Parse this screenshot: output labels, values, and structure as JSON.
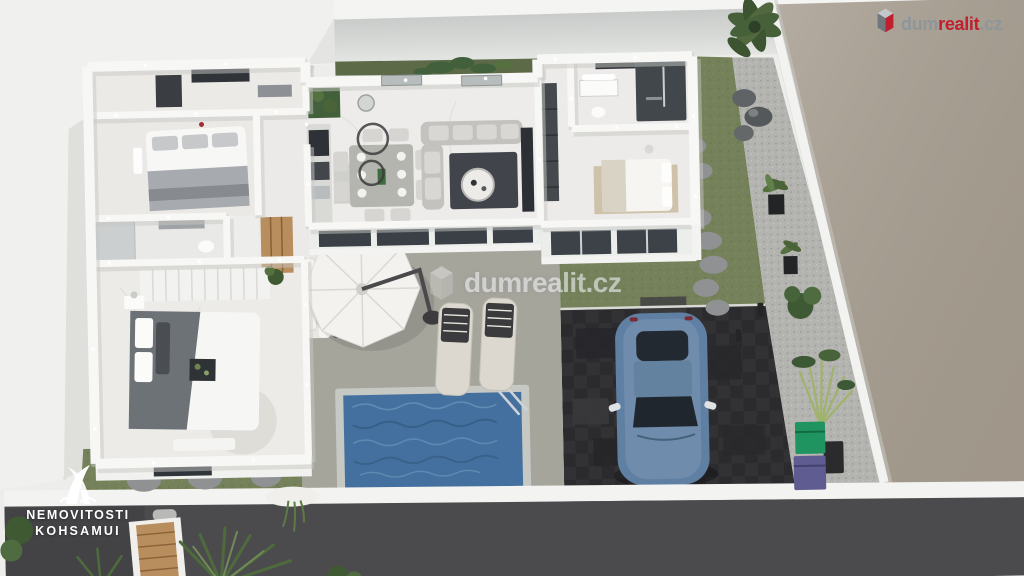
{
  "watermark": {
    "text": "dumrealit.cz"
  },
  "brand": {
    "prefix": "dum",
    "accent": "realit",
    "suffix": ".cz"
  },
  "agency": {
    "line1": "NEMOVITOSTI",
    "line2": "KOHSAMUI"
  },
  "icons": {
    "brand_icon": "dumrealit-cube-icon",
    "watermark_icon": "dumrealit-cube-icon",
    "agency_icon": "kohsamui-peaks-icon"
  },
  "colors": {
    "pool_water": "#44709f",
    "pool_coping": "#c6c8c3",
    "grass": "#75815a",
    "hedge": "#5c6a48",
    "gravel": "#b3b3af",
    "driveway": "#323235",
    "street": "#4b4b4d",
    "pavement": "#a89f91",
    "patio": "#a6a59c",
    "house_wall": "#f7f7f5",
    "car_body": "#5f7fa3",
    "wood": "#b98e5e",
    "bin_green": "#1f9460",
    "bin_purple": "#5e5c91",
    "brand_red": "#c0202e",
    "brand_gray": "#8e959b"
  }
}
